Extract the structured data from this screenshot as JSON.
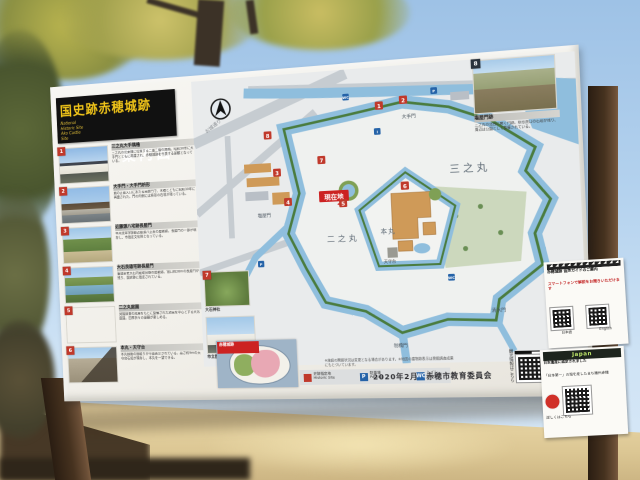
{
  "board": {
    "title": {
      "main": "国史跡赤穂城跡",
      "sub": "案内図",
      "en1": "National Historic Site",
      "en2": "Ako Castle Site"
    },
    "entries": [
      {
        "num": "1",
        "title": "三之丸大手隅櫓",
        "body": "三之丸の北東隅に位置する二重二階の隅櫓。昭和30年に大手門とともに再建され、赤穂城跡を代表する景観となっている。"
      },
      {
        "num": "2",
        "title": "大手門・大手門枡形",
        "body": "城の正面入口にあたる高麗門で、木橋とともに昭和30年に再建された。門の内側には枡形の石垣が残っている。"
      },
      {
        "num": "3",
        "title": "近藤源八宅跡長屋門",
        "body": "甲州流軍学師範近藤源八正憲の屋敷跡。長屋門の一部が現存し、市指定文化財となっている。"
      },
      {
        "num": "4",
        "title": "大石良雄宅跡長屋門",
        "body": "筆頭家老大石内蔵助良雄の屋敷跡。間口約28mの長屋門が残り、国史跡に指定されている。"
      },
      {
        "num": "5",
        "title": "二之丸庭園",
        "body": "発掘調査の成果をもとに整備された池泉を中心とする大名庭園。四季折々の景観が楽しめる。"
      },
      {
        "num": "6",
        "title": "本丸・天守台",
        "body": "本丸御殿の間取りが平面表示されている。高さ約9mの天守台石垣が現存し、本丸を一望できる。"
      }
    ],
    "map_cards": [
      {
        "num": "7",
        "caption": "大石神社"
      },
      {
        "num": "",
        "caption": "市立歴史博物館"
      }
    ],
    "aerial_card": {
      "num": "8",
      "title": "塩屋門跡",
      "body": "三之丸の北西に開く門跡。枡形虎口の石垣が残り、周辺は公園として整備されている。"
    },
    "inset_label": "赤穂城跡",
    "legend": {
      "site": "史跡指定地",
      "site_en": "Historic Site",
      "parking": "駐車場",
      "parking_en": "Parking",
      "toilet": "トイレ",
      "toilet_en": "Toilet"
    },
    "scale": "100m",
    "notes": "※施設の開館状況は変更となる場合があります。※地図の建物跡表示は発掘調査成果にもとづいています。",
    "date": "2020年2月",
    "publisher": "赤穂市教育委員会",
    "qr_caption": "観光情報はこちら"
  },
  "map": {
    "labels": {
      "sannomaru": "三之丸",
      "ninomaru": "二之丸",
      "honmaru": "本丸",
      "otemon": "大手門",
      "shioyamon": "塩屋門",
      "shimizumon": "清水門",
      "hanebashimon": "刎橋門",
      "tenshudai": "天守台",
      "street": "お城通り"
    },
    "current_location": "現在地",
    "badge_numbers": [
      "1",
      "2",
      "3",
      "4",
      "5",
      "6",
      "7",
      "8"
    ],
    "chips": {
      "parking": "P",
      "toilet": "WC",
      "info": "i"
    }
  },
  "notices": {
    "japan_heritage": {
      "header": "Japan Heritage",
      "line1": "日本遺産に認定されました",
      "line2": "「日本第一」の塩を産したまち播州赤穂",
      "line3": "詳しくはこちら"
    },
    "attached": {
      "title": "赤穂城跡 音声ガイドのご案内",
      "red_line": "スマートフォンで解説をお聞きいただけます",
      "qr1": "日本語",
      "qr2": "English"
    }
  },
  "colors": {
    "water": "#8fbedd",
    "moat_bank": "#4a7c3f",
    "building_tan": "#cf9a58",
    "badge_red": "#c0392b",
    "title_yellow": "#f0c419",
    "current_red": "#cc2222",
    "chip_blue": "#2563a8"
  }
}
